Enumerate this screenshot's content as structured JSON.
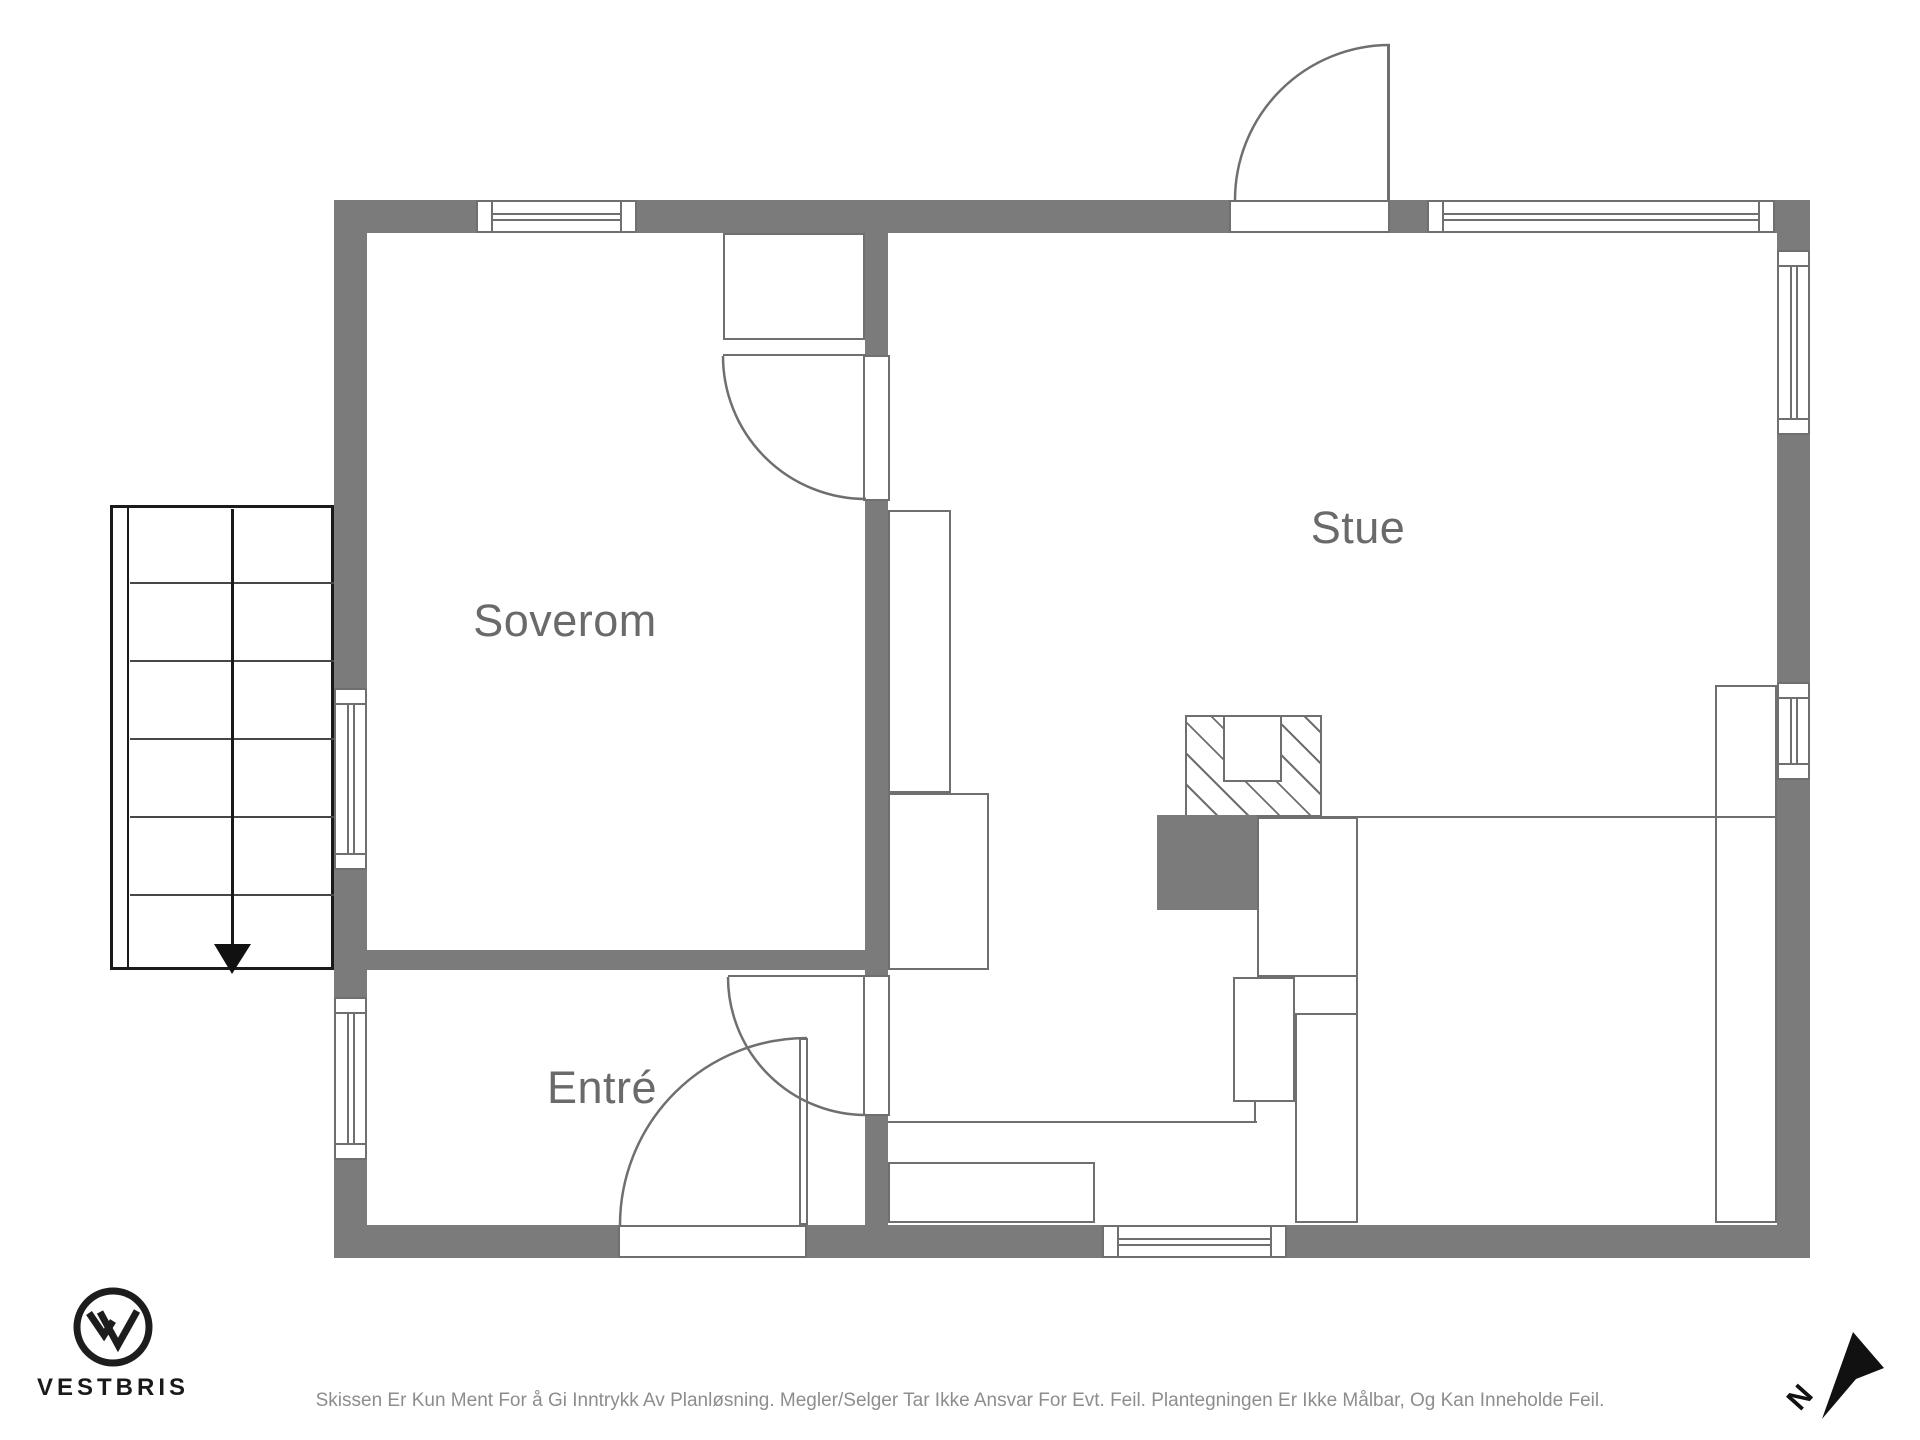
{
  "rooms": {
    "bedroom_label": "Soverom",
    "living_label": "Stue",
    "entry_label": "Entré"
  },
  "branding": {
    "logo_text": "VESTBRIS"
  },
  "compass": {
    "north_label": "N"
  },
  "footer": {
    "disclaimer": "Skissen Er Kun Ment For å Gi Inntrykk Av Planløsning. Megler/Selger Tar Ikke Ansvar For Evt. Feil. Plantegningen Er Ikke Målbar, Og Kan Inneholde Feil."
  },
  "colors": {
    "wall": "#7b7b7b",
    "line": "#6f6f6f",
    "label": "#6a6a6a",
    "ink": "#1a1a1a",
    "muted": "#8d8d8d"
  }
}
